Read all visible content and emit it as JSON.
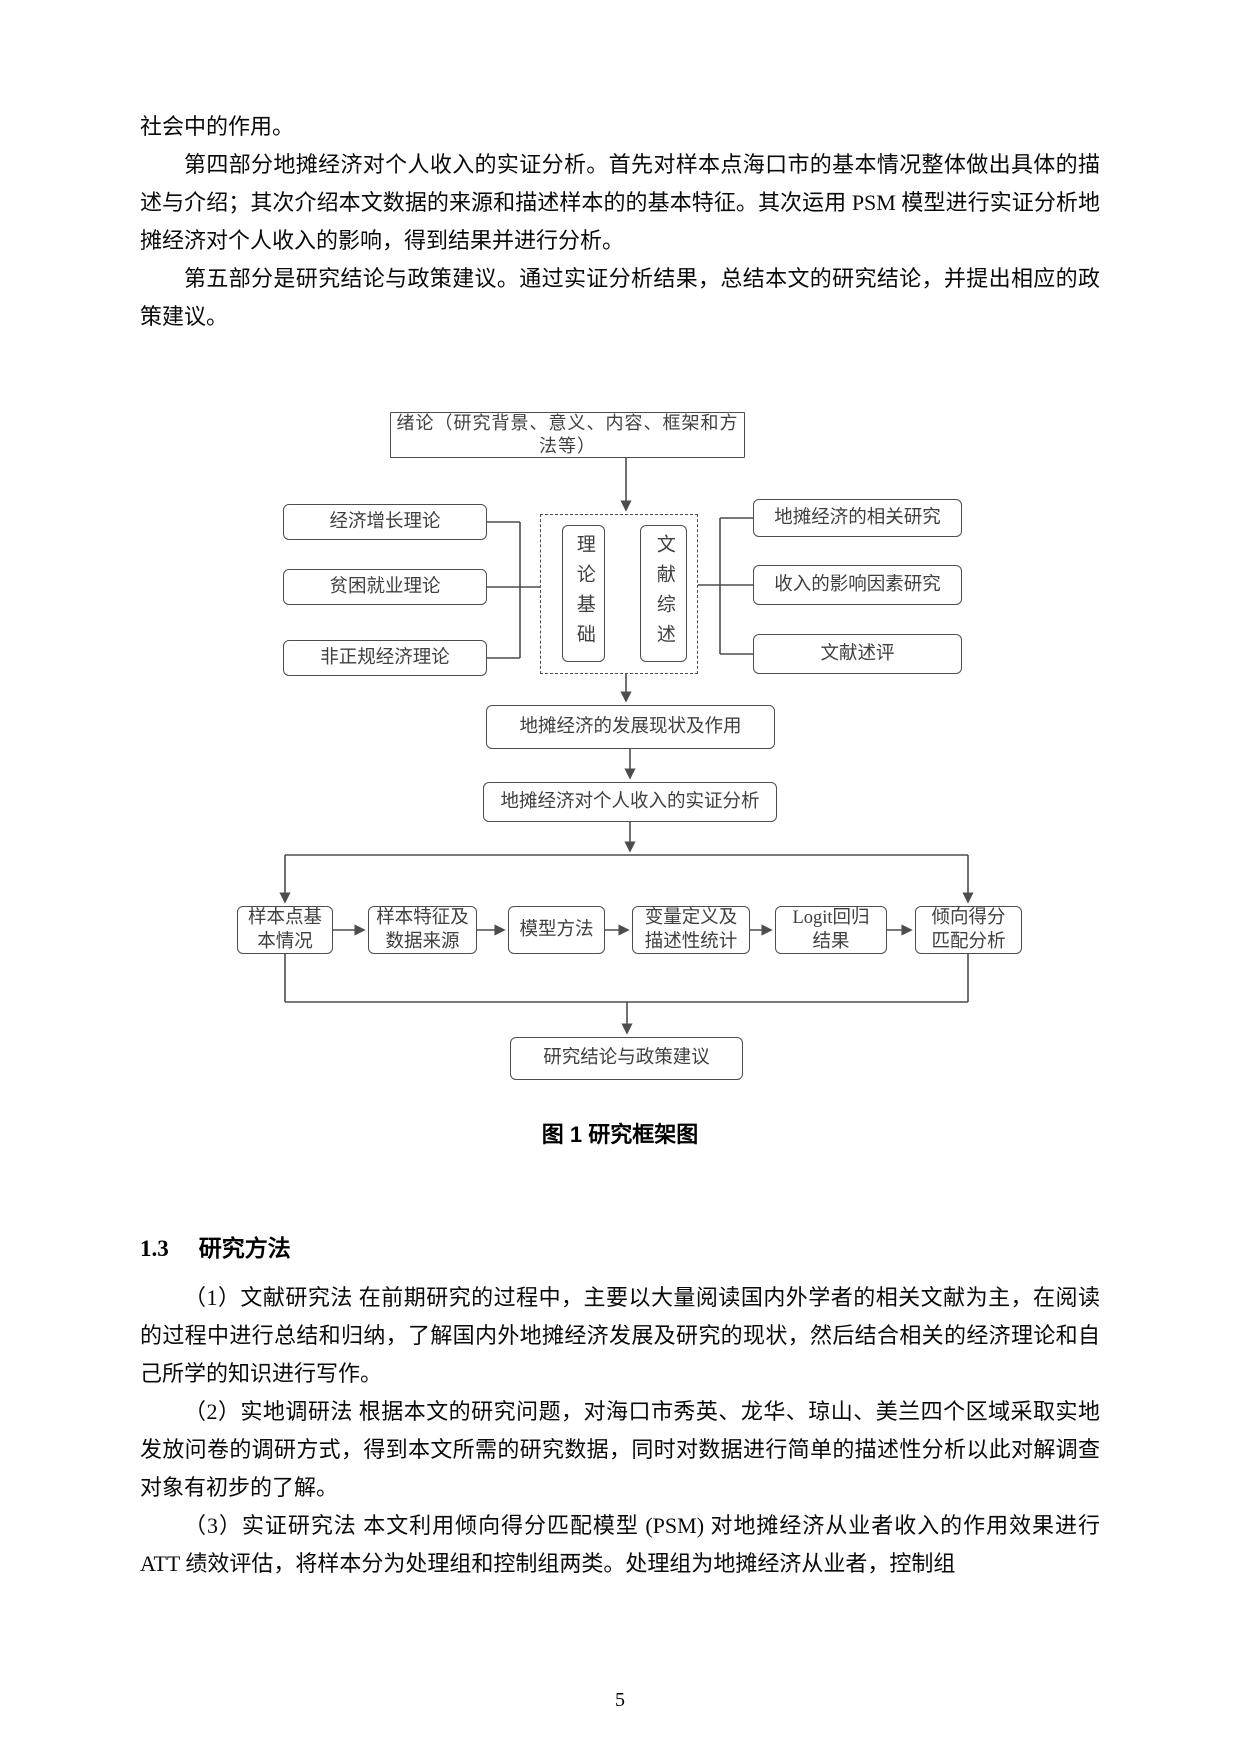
{
  "document": {
    "page_number": "5",
    "body_top": {
      "p_continuation": "社会中的作用。",
      "p_part4": "第四部分地摊经济对个人收入的实证分析。首先对样本点海口市的基本情况整体做出具体的描述与介绍；其次介绍本文数据的来源和描述样本的的基本特征。其次运用 PSM 模型进行实证分析地摊经济对个人收入的影响，得到结果并进行分析。",
      "p_part5": "第五部分是研究结论与政策建议。通过实证分析结果，总结本文的研究结论，并提出相应的政策建议。"
    },
    "figure": {
      "caption": "图 1 研究框架图",
      "nodes": {
        "intro": "绪论（研究背景、意义、内容、框架和方法等）",
        "left1": "经济增长理论",
        "left2": "贫困就业理论",
        "left3": "非正规经济理论",
        "center1": "理论基础",
        "center2": "文献综述",
        "right1": "地摊经济的相关研究",
        "right2": "收入的影响因素研究",
        "right3": "文献述评",
        "mid1": "地摊经济的发展现状及作用",
        "mid2": "地摊经济对个人收入的实证分析",
        "row1": "样本点基\n本情况",
        "row2": "样本特征及\n数据来源",
        "row3": "模型方法",
        "row4": "变量定义及\n描述性统计",
        "row5": "Logit回归\n结果",
        "row6": "倾向得分\n匹配分析",
        "bottom": "研究结论与政策建议"
      }
    },
    "section_1_3": {
      "number": "1.3",
      "title": "研究方法",
      "p_method1": "（1）文献研究法 在前期研究的过程中，主要以大量阅读国内外学者的相关文献为主，在阅读的过程中进行总结和归纳，了解国内外地摊经济发展及研究的现状，然后结合相关的经济理论和自己所学的知识进行写作。",
      "p_method2": "（2）实地调研法 根据本文的研究问题，对海口市秀英、龙华、琼山、美兰四个区域采取实地发放问卷的调研方式，得到本文所需的研究数据，同时对数据进行简单的描述性分析以此对解调查对象有初步的了解。",
      "p_method3": "（3）实证研究法 本文利用倾向得分匹配模型 (PSM) 对地摊经济从业者收入的作用效果进行 ATT 绩效评估，将样本分为处理组和控制组两类。处理组为地摊经济从业者，控制组"
    }
  }
}
